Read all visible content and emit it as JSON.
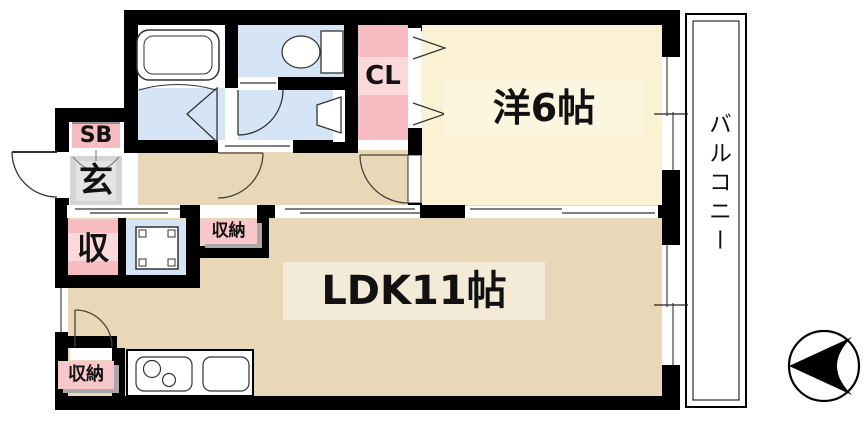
{
  "title": "apartment-floor-plan-1ldk",
  "colors": {
    "wall": "#000000",
    "floor-cream": "#fbf1d3",
    "floor-tan": "#e9d8b8",
    "floor-blue": "#d6e5f5",
    "closet-pink": "#f7bcc1",
    "closet-pink-light": "#fbd8da",
    "label-pink": "#f8c7cb",
    "tile-gray": "#d5d5d5",
    "band-cream": "#fcf5df",
    "band-tan": "#f3ead7"
  },
  "rooms": {
    "western": {
      "label": "洋6帖"
    },
    "ldk": {
      "label": "LDK11帖"
    },
    "closet": {
      "label": "CL"
    },
    "shoebox": {
      "label": "SB"
    },
    "entrance": {
      "label": "玄"
    },
    "storage": {
      "label": "収"
    },
    "storage_hall": {
      "label": "収納"
    },
    "storage_kitchen": {
      "label": "収納"
    },
    "balcony": {
      "label": "バルコニー"
    }
  },
  "icons": {
    "bathtub": "rounded-rect-tub",
    "toilet": "oval-bowl-with-tank",
    "wash_basin": "trapezoid-basin",
    "washing_machine": "square-pan-corner-pads",
    "gas_stove": "two-burner-circles",
    "kitchen_sink": "rounded-rect-sink",
    "compass_north": "circle-with-left-dart",
    "doors": "quarter-arc-swing"
  }
}
